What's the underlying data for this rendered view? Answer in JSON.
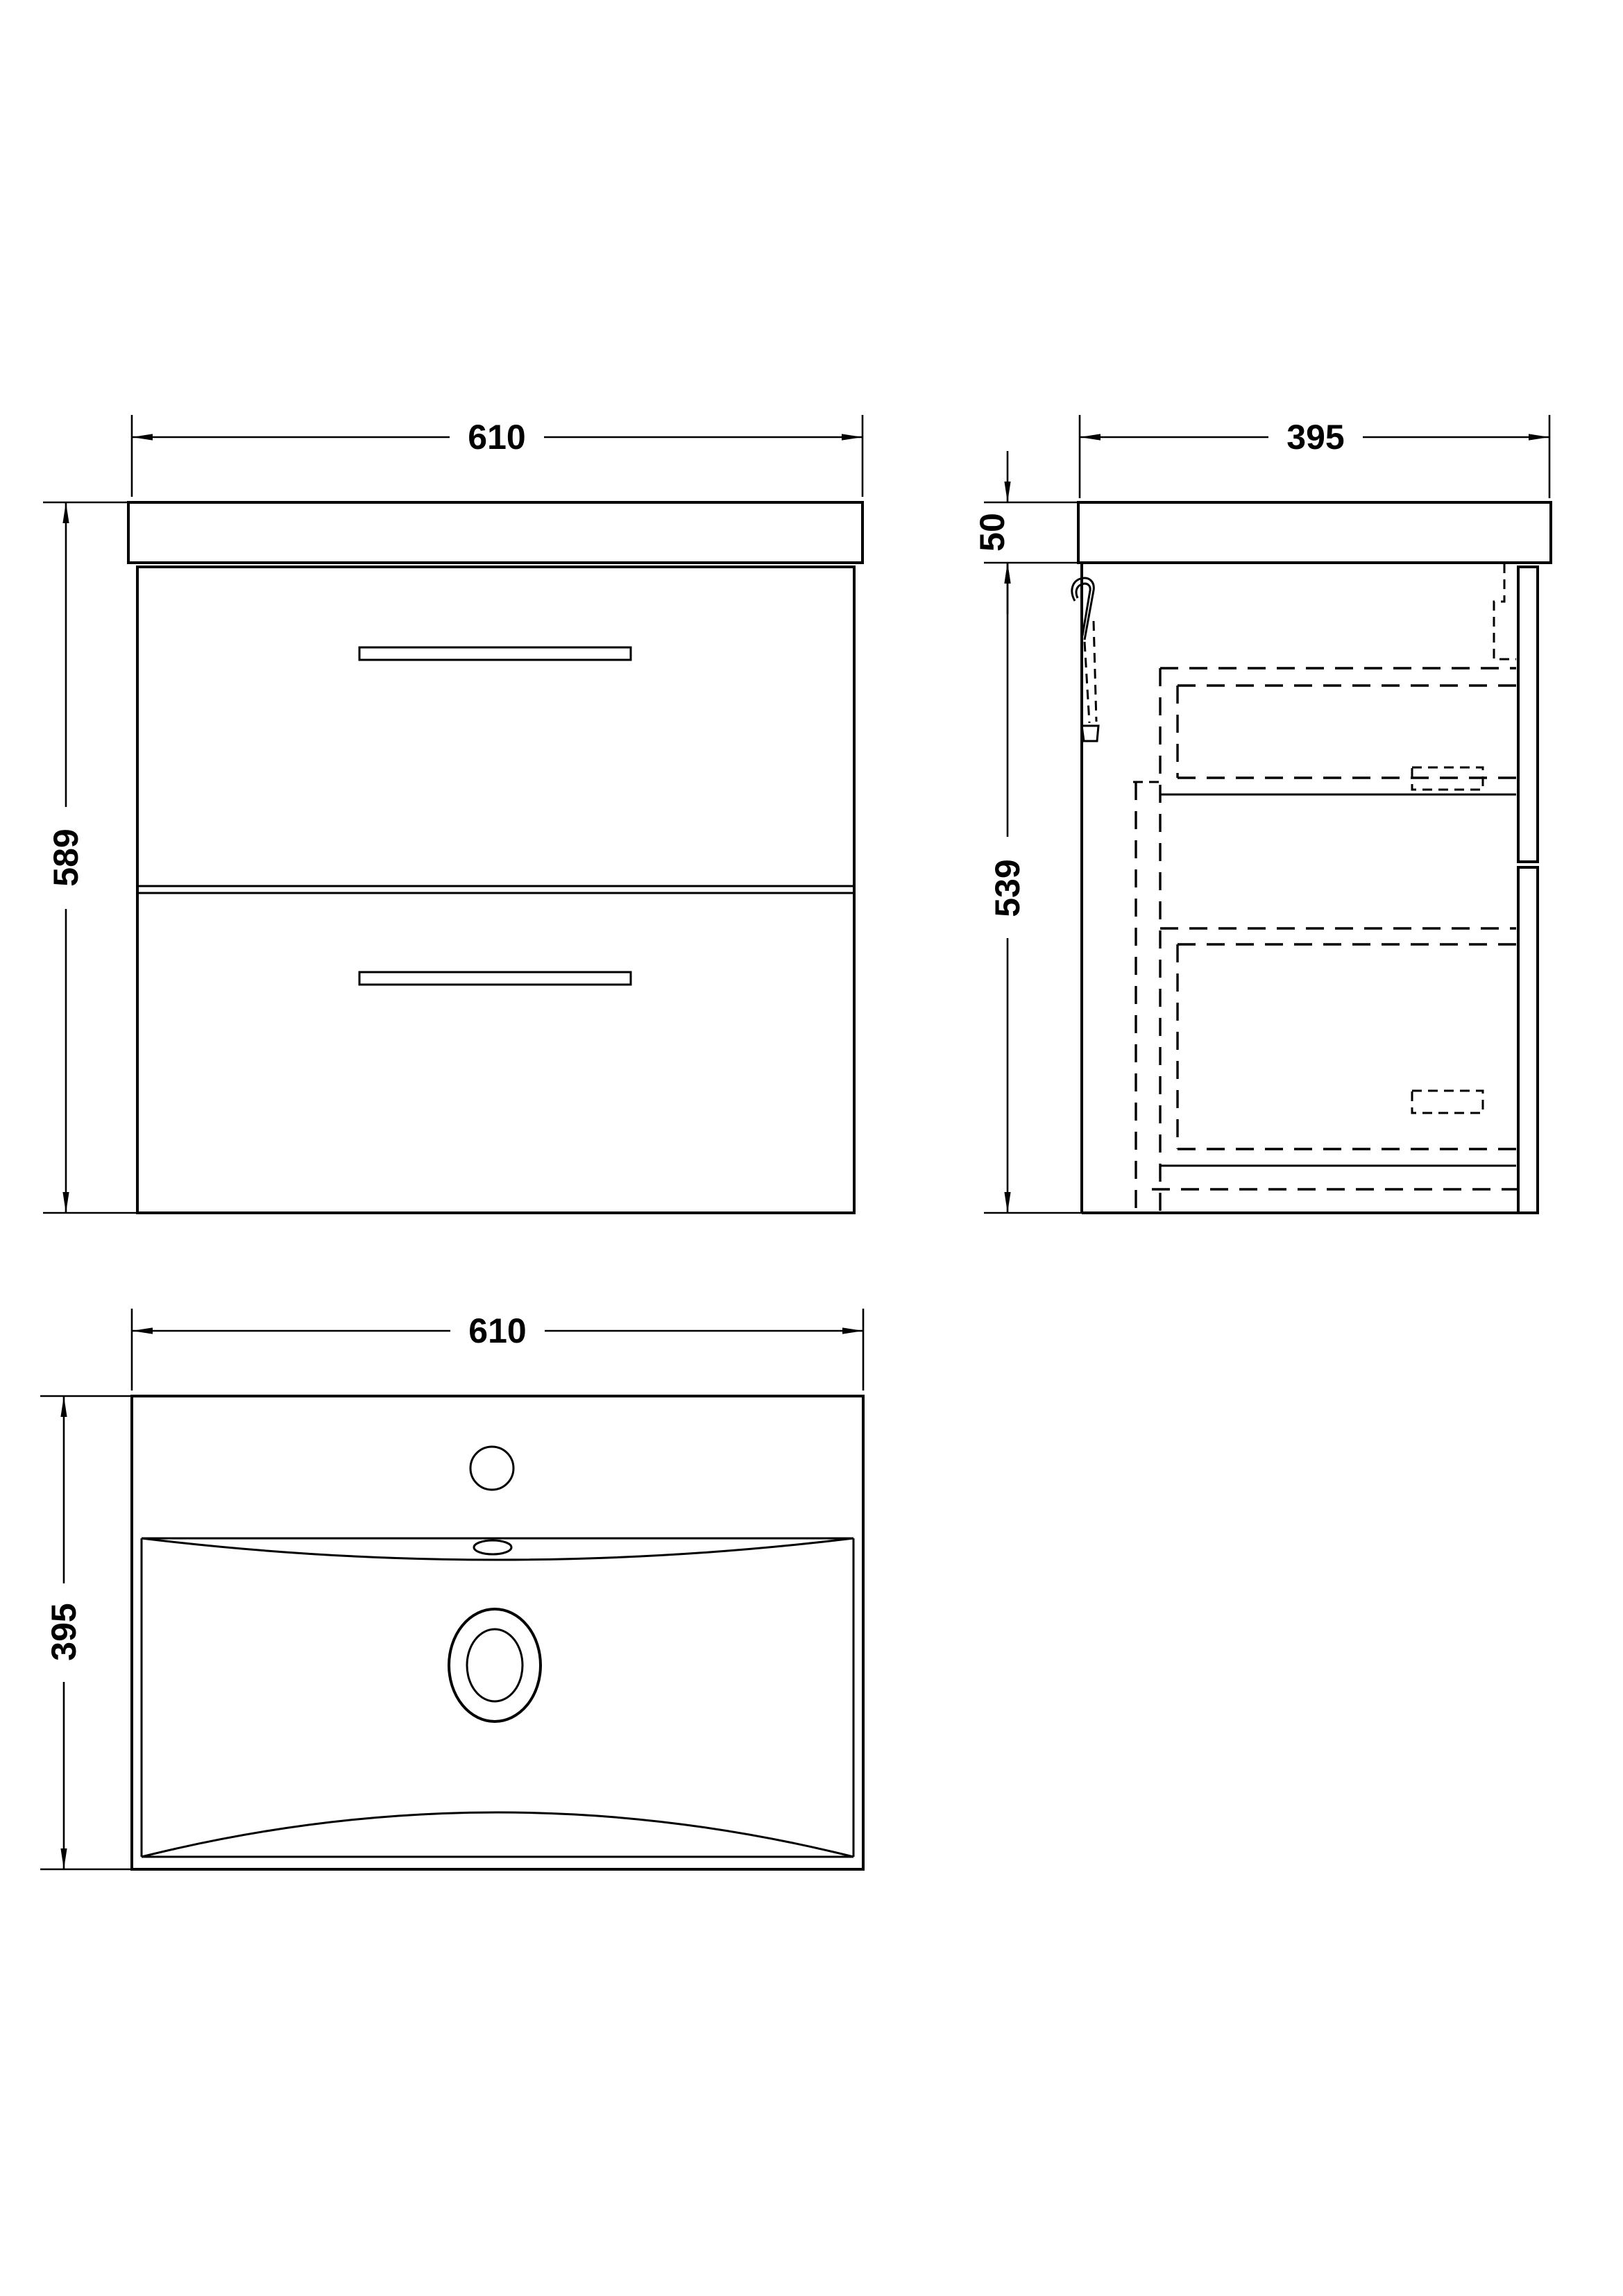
{
  "drawing": {
    "title": "Wall-hung two-drawer vanity unit with basin - orthographic technical drawing",
    "background": "#ffffff",
    "line_color": "#000000",
    "units": "mm",
    "views": {
      "front": {
        "name": "front elevation",
        "width": "610",
        "height": "589"
      },
      "side": {
        "name": "side elevation",
        "depth": "395",
        "worktop_thickness": "50",
        "cabinet_height": "539"
      },
      "plan": {
        "name": "basin plan view",
        "width": "610",
        "depth": "395"
      }
    }
  }
}
